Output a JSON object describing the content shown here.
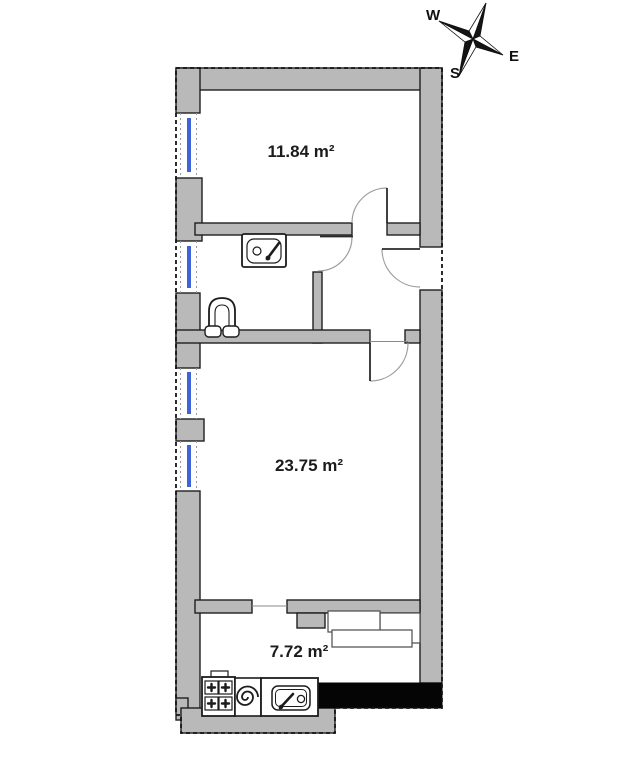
{
  "plan": {
    "type": "apartment-floor-plan",
    "rooms": [
      {
        "id": "room-top",
        "area_label": "11.84 m²"
      },
      {
        "id": "room-main",
        "area_label": "23.75 m²"
      },
      {
        "id": "room-kitchen",
        "area_label": "7.72 m²"
      }
    ],
    "fixtures": [
      "bathroom-sink",
      "toilet",
      "stove",
      "water-heater-coil",
      "kitchen-sink"
    ],
    "colors": {
      "wall_fill": "#b9b9b9",
      "wall_outline": "#1f1f1f",
      "window_glass": "#3f63d8",
      "door_arc": "#9e9e9e",
      "black_wall": "#050505",
      "background": "#ffffff"
    }
  },
  "compass": {
    "north": "N",
    "west": "W",
    "east": "E",
    "south": "S"
  }
}
